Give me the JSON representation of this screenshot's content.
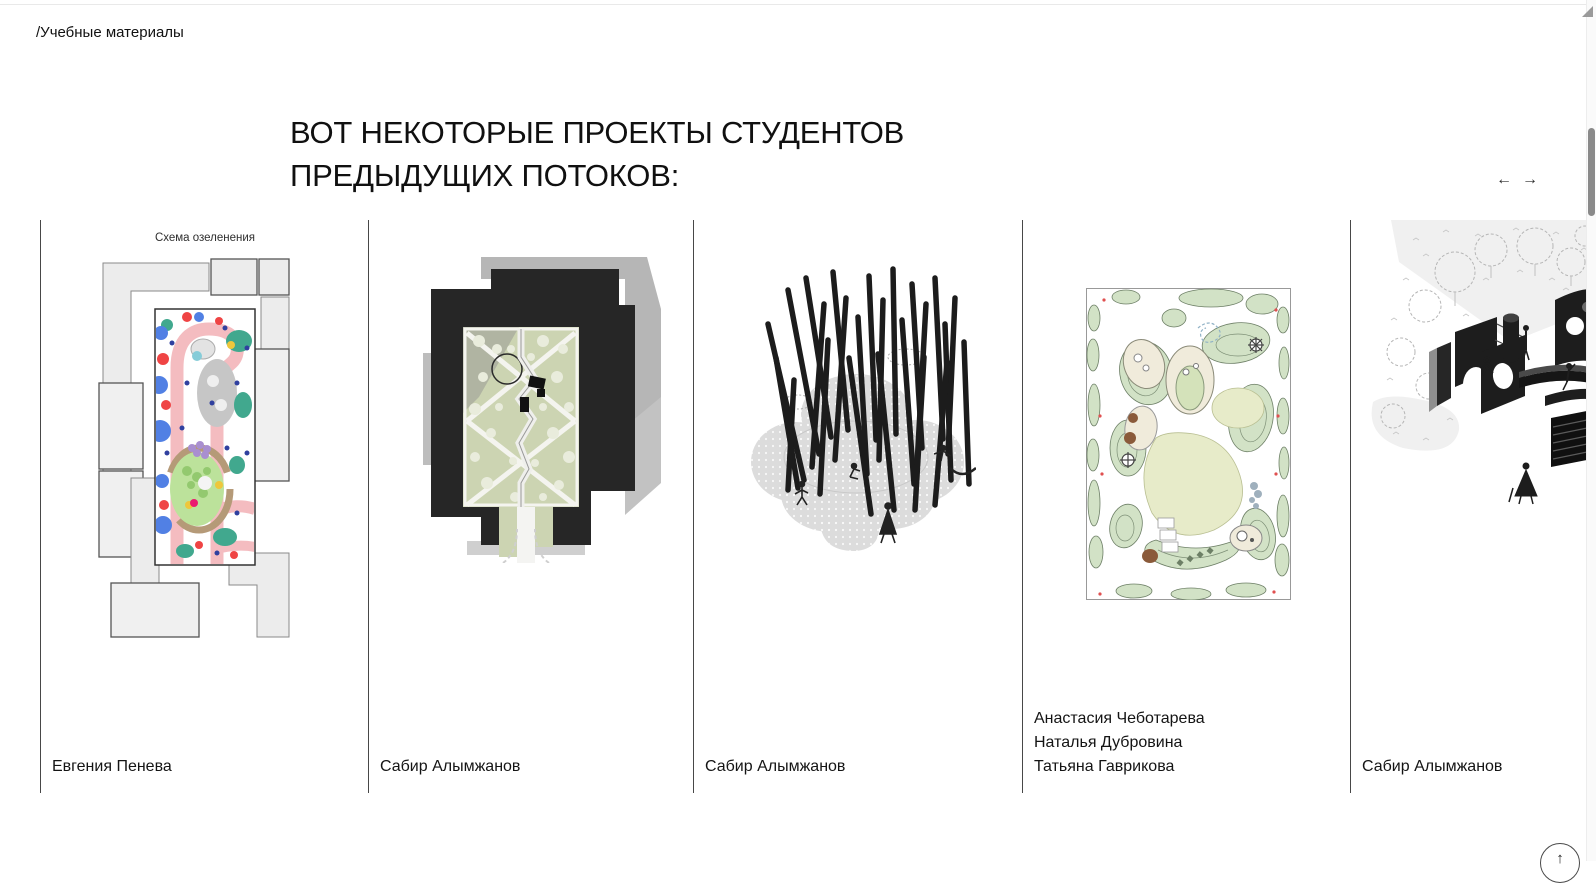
{
  "page": {
    "breadcrumb": "/Учебные материалы",
    "heading": {
      "lines": [
        "ВОТ НЕКОТОРЫЕ ПРОЕКТЫ СТУДЕНТОВ",
        "ПРЕДЫДУЩИХ ПОТОКОВ:"
      ]
    }
  },
  "carousel": {
    "prev_label": "←",
    "next_label": "→"
  },
  "cards": [
    {
      "caption": "Схема озеленения",
      "authors": [
        "Евгения Пенева"
      ]
    },
    {
      "authors": [
        "Сабир Алымжанов"
      ]
    },
    {
      "authors": [
        "Сабир Алымжанов"
      ]
    },
    {
      "authors": [
        "Анастасия Чеботарева",
        "Наталья Дубровина",
        "Татьяна Гаврикова"
      ]
    },
    {
      "authors": [
        "Сабир Алымжанов"
      ]
    }
  ],
  "scroll_top": {
    "icon": "↑"
  },
  "colors": {
    "text": "#161616",
    "divider": "#474747",
    "top_rule": "#e9e9e9",
    "scroll_thumb": "#8a8a8a",
    "plan1_pink_path": "#f4bcc0",
    "plan1_teal": "#41a88e",
    "plan1_blue": "#5180e4",
    "plan1_red": "#ef4444",
    "plan2_building": "#262626",
    "plan2_lawn": "#ccd4b2",
    "plan4_green": "#d2e2c6",
    "plan4_pale": "#e7ebc9"
  }
}
